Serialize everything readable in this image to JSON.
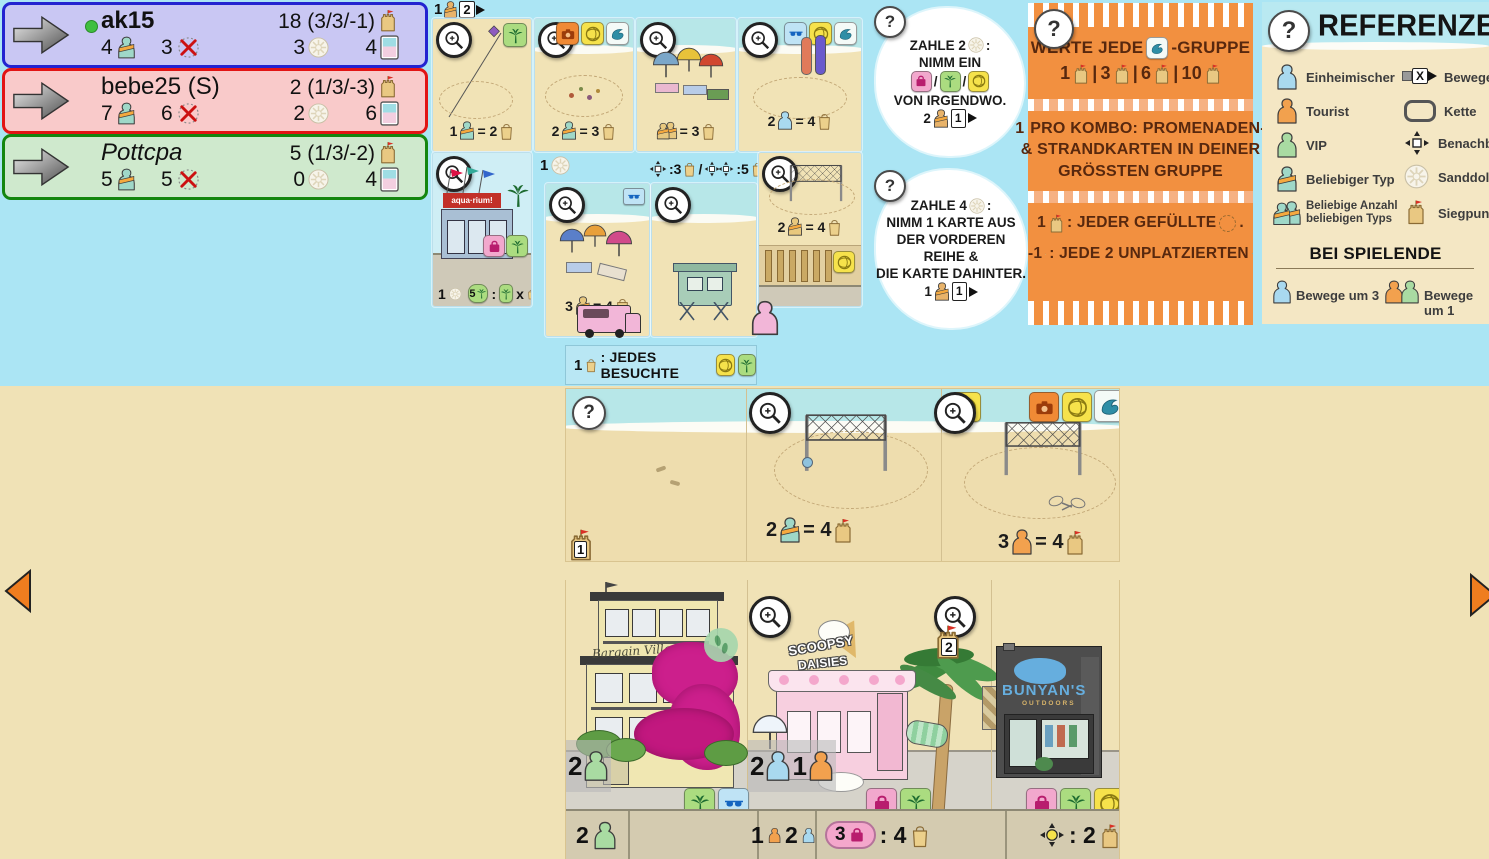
{
  "icons": {
    "question": "?",
    "slash": "/"
  },
  "players": [
    {
      "name": "ak15",
      "score": "18 (3/3/-1)",
      "figures": "4",
      "unplaced": "3",
      "sanddollars": "3",
      "cards": "4"
    },
    {
      "name": "bebe25 (S)",
      "score": "2 (1/3/-3)",
      "figures": "7",
      "unplaced": "6",
      "sanddollars": "2",
      "cards": "6"
    },
    {
      "name": "Pottcpa",
      "score": "5 (1/3/-2)",
      "figures": "5",
      "unplaced": "5",
      "sanddollars": "0",
      "cards": "4"
    }
  ],
  "turn": {
    "n": "1",
    "m": "2"
  },
  "market": {
    "r1c1": {
      "n": "1",
      "eq": "= 2"
    },
    "r1c2": {
      "n": "2",
      "eq": "= 3"
    },
    "r1c3": {
      "eq": "= 3"
    },
    "r1c4": {
      "n": "2",
      "eq": "= 4"
    },
    "aquarium": {
      "sign": "aqua·rium!",
      "sd": "1",
      "combo_n": "5",
      "combo_sep": ":",
      "combo_x": "x"
    },
    "umb": {
      "hdr": "1",
      "n": "3",
      "eq": "= 4"
    },
    "hut": {
      "h1": ":3",
      "hsl": "/",
      "h2": ":5"
    },
    "vb": {
      "n": "2",
      "eq": "= 4"
    }
  },
  "bonus": {
    "n": "1",
    "text": ": JEDES BESUCHTE"
  },
  "tips": [
    {
      "t1": "ZAHLE 2",
      "t1b": ":",
      "t2": "NIMM EIN",
      "t3": "VON IRGENDWO.",
      "cn": "2",
      "cm": "1"
    },
    {
      "t1": "ZAHLE 4",
      "t1b": ":",
      "t2": "NIMM 1 KARTE AUS",
      "t3": "DER VORDEREN REIHE &",
      "t4": "DIE KARTE DAHINTER.",
      "cn": "1",
      "cm": "1"
    }
  ],
  "scoring": {
    "l1a": "WERTE JEDE",
    "l1b": "-GRUPPE",
    "l2": [
      {
        "n": "1"
      },
      {
        "n": "3"
      },
      {
        "n": "6"
      },
      {
        "n": "10"
      }
    ],
    "sep": "|",
    "l3a": "1",
    "l3b": "PRO KOMBO: PROMENADEN-",
    "l3c": "& STRANDKARTEN IN DEINER",
    "l3d": "GRÖSSTEN GRUPPE",
    "l4a": "1",
    "l4b": ": JEDER GEFÜLLTE",
    "l4c": ".",
    "l5a": "-1",
    "l5b": ": JEDE 2 UNPLATZIERTEN"
  },
  "reference": {
    "title": "REFERENZEN",
    "left": [
      "Einheimischer",
      "Tourist",
      "VIP",
      "Beliebiger Typ",
      "Beliebige Anzahl beliebigen Typs"
    ],
    "right": [
      "Bewege",
      "Kette",
      "Benachbart",
      "Sanddollar",
      "Siegpunkt"
    ],
    "movex": "X",
    "end_title": "BEI SPIELENDE",
    "end1": "Bewege um 3",
    "end2": "Bewege um 1"
  },
  "board": {
    "castle1": "1",
    "castle2": "2",
    "beach_b": {
      "n": "2",
      "eq": "= 4"
    },
    "beach_c": {
      "n": "3",
      "eq": "= 4"
    },
    "villas": {
      "sign": "Bargain Villas",
      "over_n": "2",
      "bar_n": "2"
    },
    "scoopsy": {
      "sign1": "SCOOPSY",
      "sign2": "DAISIES",
      "over_n1": "2",
      "over_n2": "1",
      "bar_n1": "1",
      "bar_n2": "2",
      "badge_n": "3",
      "badge_val": ": 4"
    },
    "bunyans": {
      "sign": "BUNYAN'S",
      "sub": "OUTDOORS",
      "bar_val": ": 2"
    }
  }
}
